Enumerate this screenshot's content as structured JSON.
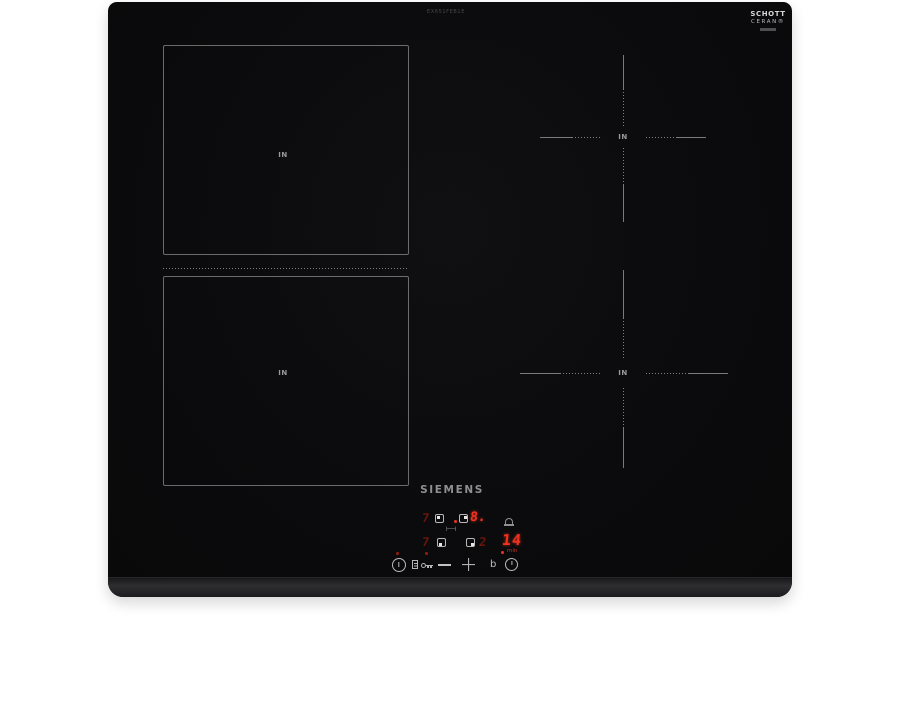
{
  "product": {
    "brand": "SIEMENS",
    "model_text": "EX651FEB1E",
    "glass_logo": {
      "line1": "SCHOTT",
      "line2": "CERAN®"
    }
  },
  "zones": [
    {
      "id": "flex-rear-left",
      "label": "IN"
    },
    {
      "id": "flex-front-left",
      "label": "IN"
    },
    {
      "id": "rear-right",
      "label": "IN"
    },
    {
      "id": "front-right",
      "label": "IN"
    }
  ],
  "display": {
    "rear_left_level": "7",
    "rear_right_level": "8.",
    "front_left_level": "7",
    "front_right_level": "2",
    "timer_value": "14",
    "timer_unit": "min",
    "bridge_symbol": "⊢⊣"
  },
  "controls": {
    "minus_label": "",
    "plus_label": "",
    "boost_label": "b"
  },
  "colors": {
    "glass": "#0b0b0d",
    "accent_red_bright": "#f5301d",
    "accent_red_dim": "#6b150b",
    "marking_gray": "#9a9a9a"
  }
}
